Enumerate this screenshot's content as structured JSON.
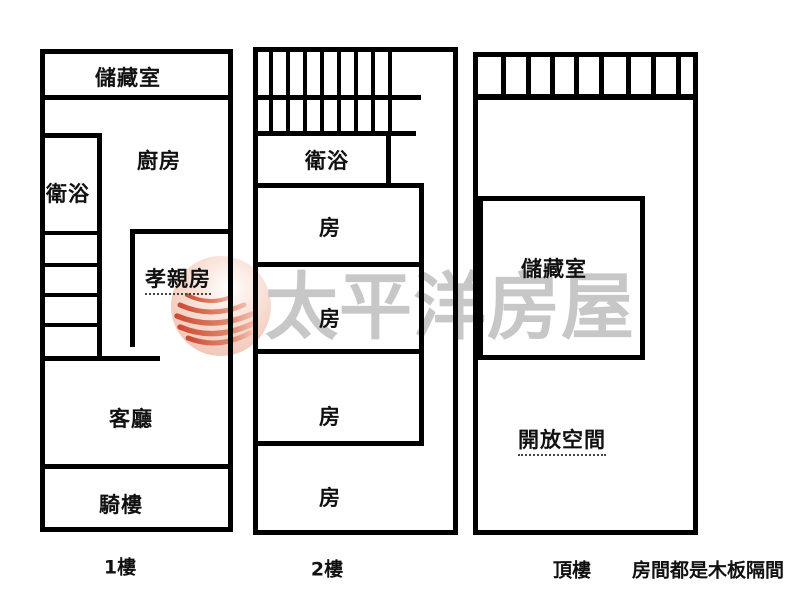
{
  "watermark": {
    "brand_text": "太平洋房屋",
    "logo_icon": "pacific-waves-sphere-logo",
    "text_color": "#c7c7c7",
    "logo_fill_color": "#f2c6b8",
    "logo_wave_color": "#d4563c"
  },
  "wall_color": "#000000",
  "background_color": "#ffffff",
  "plans": [
    {
      "floor_label": "1樓",
      "rooms": {
        "storage": "儲藏室",
        "kitchen": "廚房",
        "bathroom": "衛浴",
        "parents_room": "孝親房",
        "living_room": "客廳",
        "arcade": "騎樓"
      }
    },
    {
      "floor_label": "2樓",
      "rooms": {
        "bathroom": "衛浴",
        "room_1": "房",
        "room_2": "房",
        "room_3": "房",
        "room_4": "房"
      }
    },
    {
      "floor_label": "頂樓",
      "rooms": {
        "storage": "儲藏室",
        "open_space": "開放空間"
      }
    }
  ],
  "note": "房間都是木板隔間"
}
